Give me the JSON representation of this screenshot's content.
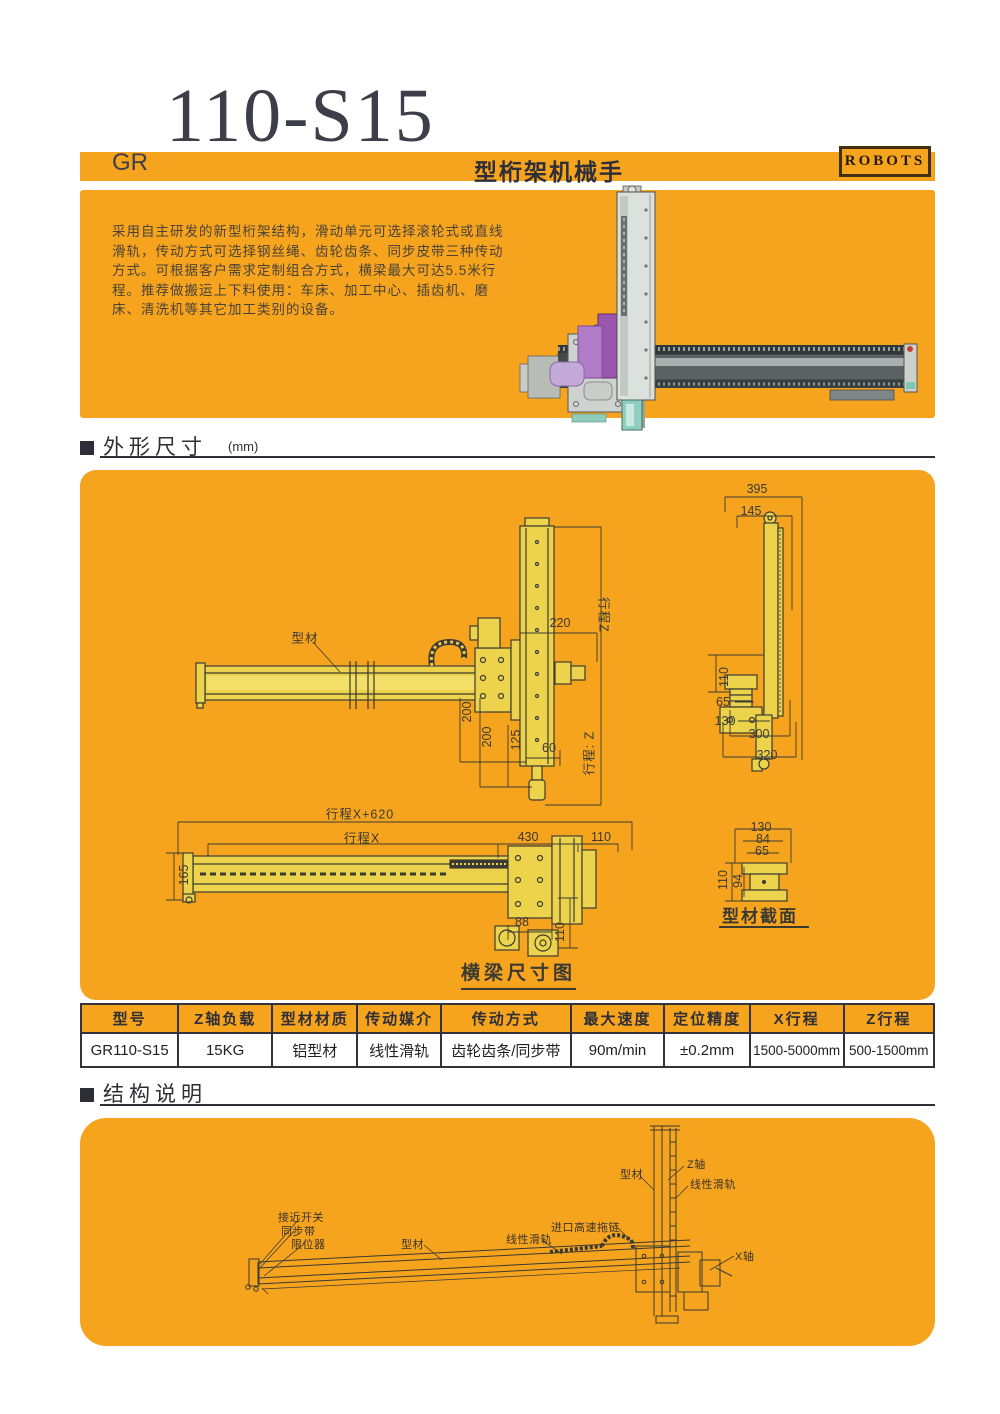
{
  "header": {
    "gr": "GR",
    "model": "110-S15",
    "type_suffix": "型桁架机械手",
    "badge": "ROBOTS"
  },
  "intro": {
    "line1": "采用自主研发的新型桁架结构，滑动单元可选择滚轮式或直线",
    "line2": "滑轨，传动方式可选择钢丝绳、齿轮齿条、同步皮带三种传动",
    "line3": "方式。可根据客户需求定制组合方式，横梁最大可达5.5米行",
    "line4": "程。推荐做搬运上下料使用：车床、加工中心、插齿机、磨",
    "line5": "床、清洗机等其它加工类别的设备。"
  },
  "section_dimensions": {
    "title": "外形尺寸",
    "unit": "(mm)"
  },
  "section_structure": {
    "title": "结构说明"
  },
  "drawing": {
    "front": {
      "profile": "型材",
      "d220": "220",
      "strokeZ": "行程Z",
      "d200a": "200",
      "d200b": "200",
      "d125": "125",
      "d60": "60",
      "strokeZ2": "行程: Z"
    },
    "side": {
      "d395": "395",
      "d145": "145",
      "d110": "110",
      "d65": "65",
      "d130": "130",
      "d300": "300",
      "d320": "320"
    },
    "top": {
      "strokeX620": "行程X+620",
      "strokeX": "行程X",
      "d430": "430",
      "d110": "110",
      "d165": "165",
      "d88": "88",
      "d110b": "110"
    },
    "section": {
      "d130": "130",
      "d84": "84",
      "d65": "65",
      "d110": "110",
      "d94": "94",
      "label": "型材截面"
    },
    "caption": "横梁尺寸图"
  },
  "table": {
    "headers": [
      "型号",
      "Z轴负载",
      "型材材质",
      "传动媒介",
      "传动方式",
      "最大速度",
      "定位精度",
      "X行程",
      "Z行程"
    ],
    "row": [
      "GR110-S15",
      "15KG",
      "铝型材",
      "线性滑轨",
      "齿轮齿条/同步带",
      "90m/min",
      "±0.2mm",
      "1500-5000mm",
      "500-1500mm"
    ]
  },
  "structure": {
    "proximity": "接近开关",
    "belt": "同步带",
    "limiter": "限位器",
    "profile1": "型材",
    "rail1": "线性滑轨",
    "chain": "进口高速拖链",
    "profile2": "型材",
    "zaxis": "Z轴",
    "rail2": "线性滑轨",
    "xaxis": "X轴"
  },
  "colors": {
    "orange": "#f6a41e",
    "ink": "#33333b",
    "beam_yellow": "#edd34b"
  }
}
